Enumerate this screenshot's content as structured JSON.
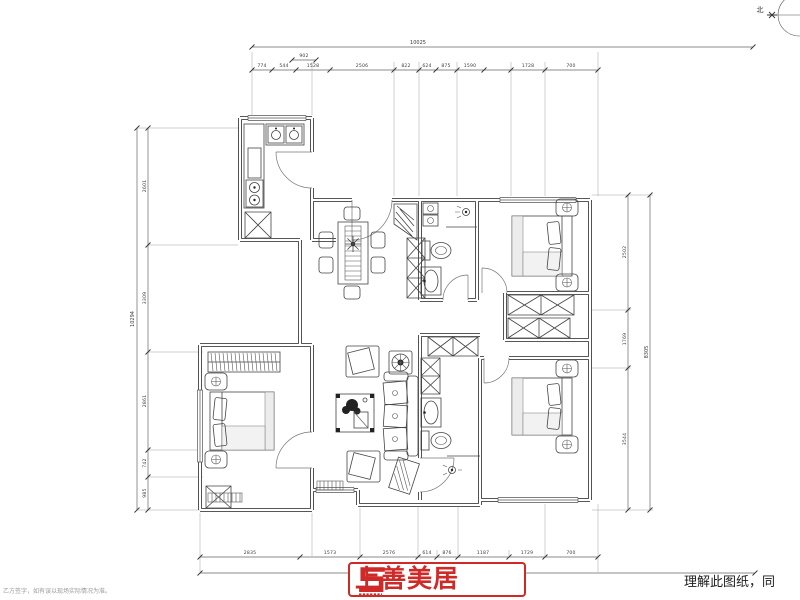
{
  "compass": {
    "north_label": "北"
  },
  "dimensions": {
    "top": {
      "total": "10025",
      "upper_segment": "902",
      "segments": [
        "774",
        "544",
        "1528",
        "2506",
        "822",
        "624",
        "875",
        "1590",
        "1728",
        "700"
      ]
    },
    "left": {
      "total": "10294",
      "segments": [
        "2601",
        "3309",
        "2861",
        "742",
        "985"
      ]
    },
    "right": {
      "total": "8305",
      "segments": [
        "2502",
        "1769",
        "3544"
      ]
    },
    "bottom": {
      "segments": [
        "2835",
        "1573",
        "2576",
        "614",
        "876",
        "1187",
        "1729",
        "700"
      ]
    }
  },
  "logo": {
    "name": "上善美居"
  },
  "captions": {
    "bottom_right": "理解此图纸，同",
    "bottom_left": "乙方签字，如有误以现场实际情况为准。"
  }
}
